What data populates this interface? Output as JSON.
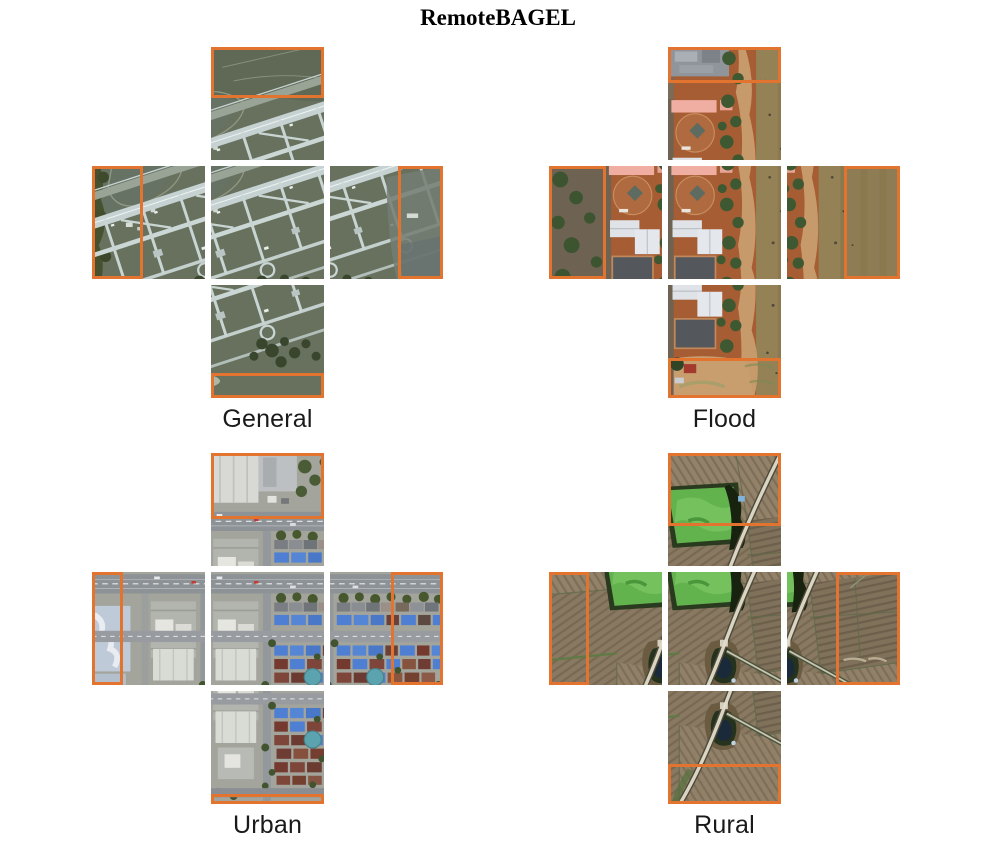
{
  "title": "RemoteBAGEL",
  "colors": {
    "highlight_box": "#E2742F",
    "page_bg": "#FFFFFF",
    "label_text": "#1A1A1A",
    "flood_pink": "#F0ADA2"
  },
  "figure": {
    "tile_size": 113,
    "tile_gap": 6,
    "note_icons": [],
    "panel_count": 4
  },
  "panels": [
    {
      "id": "general",
      "label": "General",
      "scene": "scene-general",
      "palette": [
        "#68715E",
        "#C6D2D2",
        "#46512F"
      ],
      "tiles": [
        {
          "pos": "top",
          "window": [
            50,
            0
          ],
          "highlight": [
            0,
            0,
            100,
            45
          ]
        },
        {
          "pos": "left",
          "window": [
            0,
            50
          ],
          "highlight": [
            0,
            0,
            45,
            100
          ]
        },
        {
          "pos": "center",
          "window": [
            50,
            50
          ],
          "highlight": null
        },
        {
          "pos": "right",
          "window": [
            100,
            50
          ],
          "highlight": [
            60,
            0,
            40,
            100
          ]
        },
        {
          "pos": "bottom",
          "window": [
            50,
            100
          ],
          "highlight": [
            0,
            78,
            100,
            22
          ]
        }
      ]
    },
    {
      "id": "flood",
      "label": "Flood",
      "scene": "scene-flood",
      "palette": [
        "#A75D33",
        "#8E7C54",
        "#F0ADA2",
        "#6E6252"
      ],
      "tiles": [
        {
          "pos": "top",
          "window": [
            50,
            0
          ],
          "highlight": [
            0,
            0,
            100,
            32
          ]
        },
        {
          "pos": "left",
          "window": [
            0,
            50
          ],
          "highlight": [
            0,
            0,
            50,
            100
          ]
        },
        {
          "pos": "center",
          "window": [
            50,
            50
          ],
          "highlight": null
        },
        {
          "pos": "right",
          "window": [
            100,
            50
          ],
          "highlight": [
            50,
            0,
            50,
            100
          ]
        },
        {
          "pos": "bottom",
          "window": [
            50,
            100
          ],
          "highlight": [
            0,
            65,
            100,
            35
          ]
        }
      ]
    },
    {
      "id": "urban",
      "label": "Urban",
      "scene": "scene-urban",
      "palette": [
        "#A3A49B",
        "#4F7FD2",
        "#743A30",
        "#BFCAD8"
      ],
      "tiles": [
        {
          "pos": "top",
          "window": [
            50,
            0
          ],
          "highlight": [
            0,
            0,
            100,
            58
          ]
        },
        {
          "pos": "left",
          "window": [
            0,
            50
          ],
          "highlight": [
            0,
            0,
            27,
            100
          ]
        },
        {
          "pos": "center",
          "window": [
            50,
            50
          ],
          "highlight": null
        },
        {
          "pos": "right",
          "window": [
            100,
            50
          ],
          "highlight": [
            54,
            0,
            46,
            100
          ]
        },
        {
          "pos": "bottom",
          "window": [
            50,
            100
          ],
          "highlight": [
            0,
            91,
            100,
            9
          ]
        }
      ]
    },
    {
      "id": "rural",
      "label": "Rural",
      "scene": "scene-rural",
      "palette": [
        "#8B7A61",
        "#62B24E",
        "#DAD4C2"
      ],
      "tiles": [
        {
          "pos": "top",
          "window": [
            50,
            0
          ],
          "highlight": [
            0,
            0,
            100,
            65
          ]
        },
        {
          "pos": "left",
          "window": [
            0,
            50
          ],
          "highlight": [
            0,
            0,
            35,
            100
          ]
        },
        {
          "pos": "center",
          "window": [
            50,
            50
          ],
          "highlight": null
        },
        {
          "pos": "right",
          "window": [
            100,
            50
          ],
          "highlight": [
            43,
            0,
            57,
            100
          ]
        },
        {
          "pos": "bottom",
          "window": [
            50,
            100
          ],
          "highlight": [
            0,
            65,
            100,
            35
          ]
        }
      ]
    }
  ]
}
